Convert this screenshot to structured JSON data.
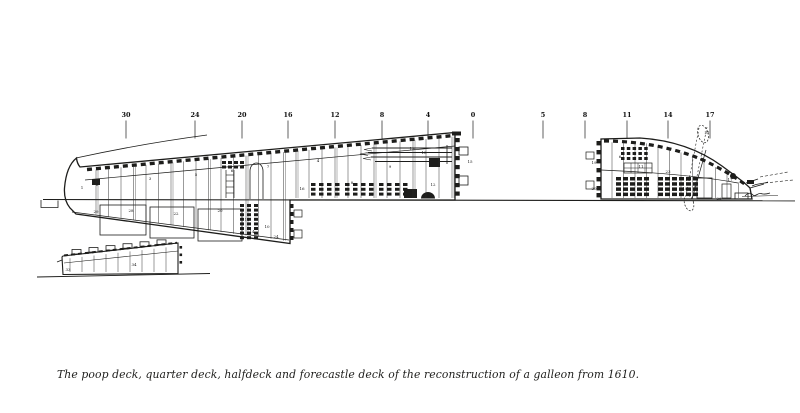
{
  "figure": {
    "kind": "technical side-section drawing, black ink on white paper",
    "caption": "The poop deck, quarter deck, halfdeck and forecastle deck of the reconstruction of a galleon from 1610."
  },
  "stations": [
    {
      "label": "30",
      "x": 126
    },
    {
      "label": "24",
      "x": 195
    },
    {
      "label": "20",
      "x": 242
    },
    {
      "label": "16",
      "x": 288
    },
    {
      "label": "12",
      "x": 335
    },
    {
      "label": "8",
      "x": 382
    },
    {
      "label": "4",
      "x": 428
    },
    {
      "label": "0",
      "x": 473
    },
    {
      "label": "5",
      "x": 543
    },
    {
      "label": "8",
      "x": 585
    },
    {
      "label": "11",
      "x": 627
    },
    {
      "label": "14",
      "x": 668
    },
    {
      "label": "17",
      "x": 710
    }
  ],
  "part_labels": {
    "quarter_deck_section": [
      {
        "n": "1",
        "x": 82,
        "y": 189
      },
      {
        "n": "2",
        "x": 97,
        "y": 186
      },
      {
        "n": "3",
        "x": 150,
        "y": 180
      },
      {
        "n": "5",
        "x": 196,
        "y": 176
      },
      {
        "n": "6",
        "x": 232,
        "y": 172
      },
      {
        "n": "7",
        "x": 268,
        "y": 168
      },
      {
        "n": "29",
        "x": 96,
        "y": 213
      },
      {
        "n": "28",
        "x": 131,
        "y": 212
      },
      {
        "n": "22",
        "x": 176,
        "y": 215
      },
      {
        "n": "20",
        "x": 220,
        "y": 212
      },
      {
        "n": "11",
        "x": 247,
        "y": 221
      },
      {
        "n": "14",
        "x": 252,
        "y": 233
      },
      {
        "n": "24",
        "x": 276,
        "y": 238
      },
      {
        "n": "10",
        "x": 267,
        "y": 228
      }
    ],
    "halfdeck_section": [
      {
        "n": "4",
        "x": 318,
        "y": 162
      },
      {
        "n": "8",
        "x": 352,
        "y": 184
      },
      {
        "n": "9",
        "x": 390,
        "y": 168
      },
      {
        "n": "13",
        "x": 412,
        "y": 150
      },
      {
        "n": "18",
        "x": 424,
        "y": 154
      },
      {
        "n": "12",
        "x": 433,
        "y": 186
      },
      {
        "n": "16",
        "x": 302,
        "y": 190
      },
      {
        "n": "26",
        "x": 371,
        "y": 196
      },
      {
        "n": "15",
        "x": 470,
        "y": 163
      }
    ],
    "forecastle_section": [
      {
        "n": "19",
        "x": 594,
        "y": 164
      },
      {
        "n": "20",
        "x": 594,
        "y": 190
      },
      {
        "n": "6",
        "x": 620,
        "y": 158
      },
      {
        "n": "11",
        "x": 641,
        "y": 168
      },
      {
        "n": "23",
        "x": 668,
        "y": 173
      },
      {
        "n": "10",
        "x": 688,
        "y": 181
      },
      {
        "n": "18",
        "x": 685,
        "y": 190
      },
      {
        "n": "21",
        "x": 707,
        "y": 134
      },
      {
        "n": "17",
        "x": 730,
        "y": 181
      },
      {
        "n": "26",
        "x": 719,
        "y": 200
      }
    ],
    "poop_deck_section": [
      {
        "n": "33",
        "x": 68,
        "y": 271
      },
      {
        "n": "34",
        "x": 134,
        "y": 266
      }
    ]
  },
  "colors": {
    "ink": "#1d1d1b",
    "light_ink": "#3a3a3a",
    "paper": "#ffffff"
  }
}
